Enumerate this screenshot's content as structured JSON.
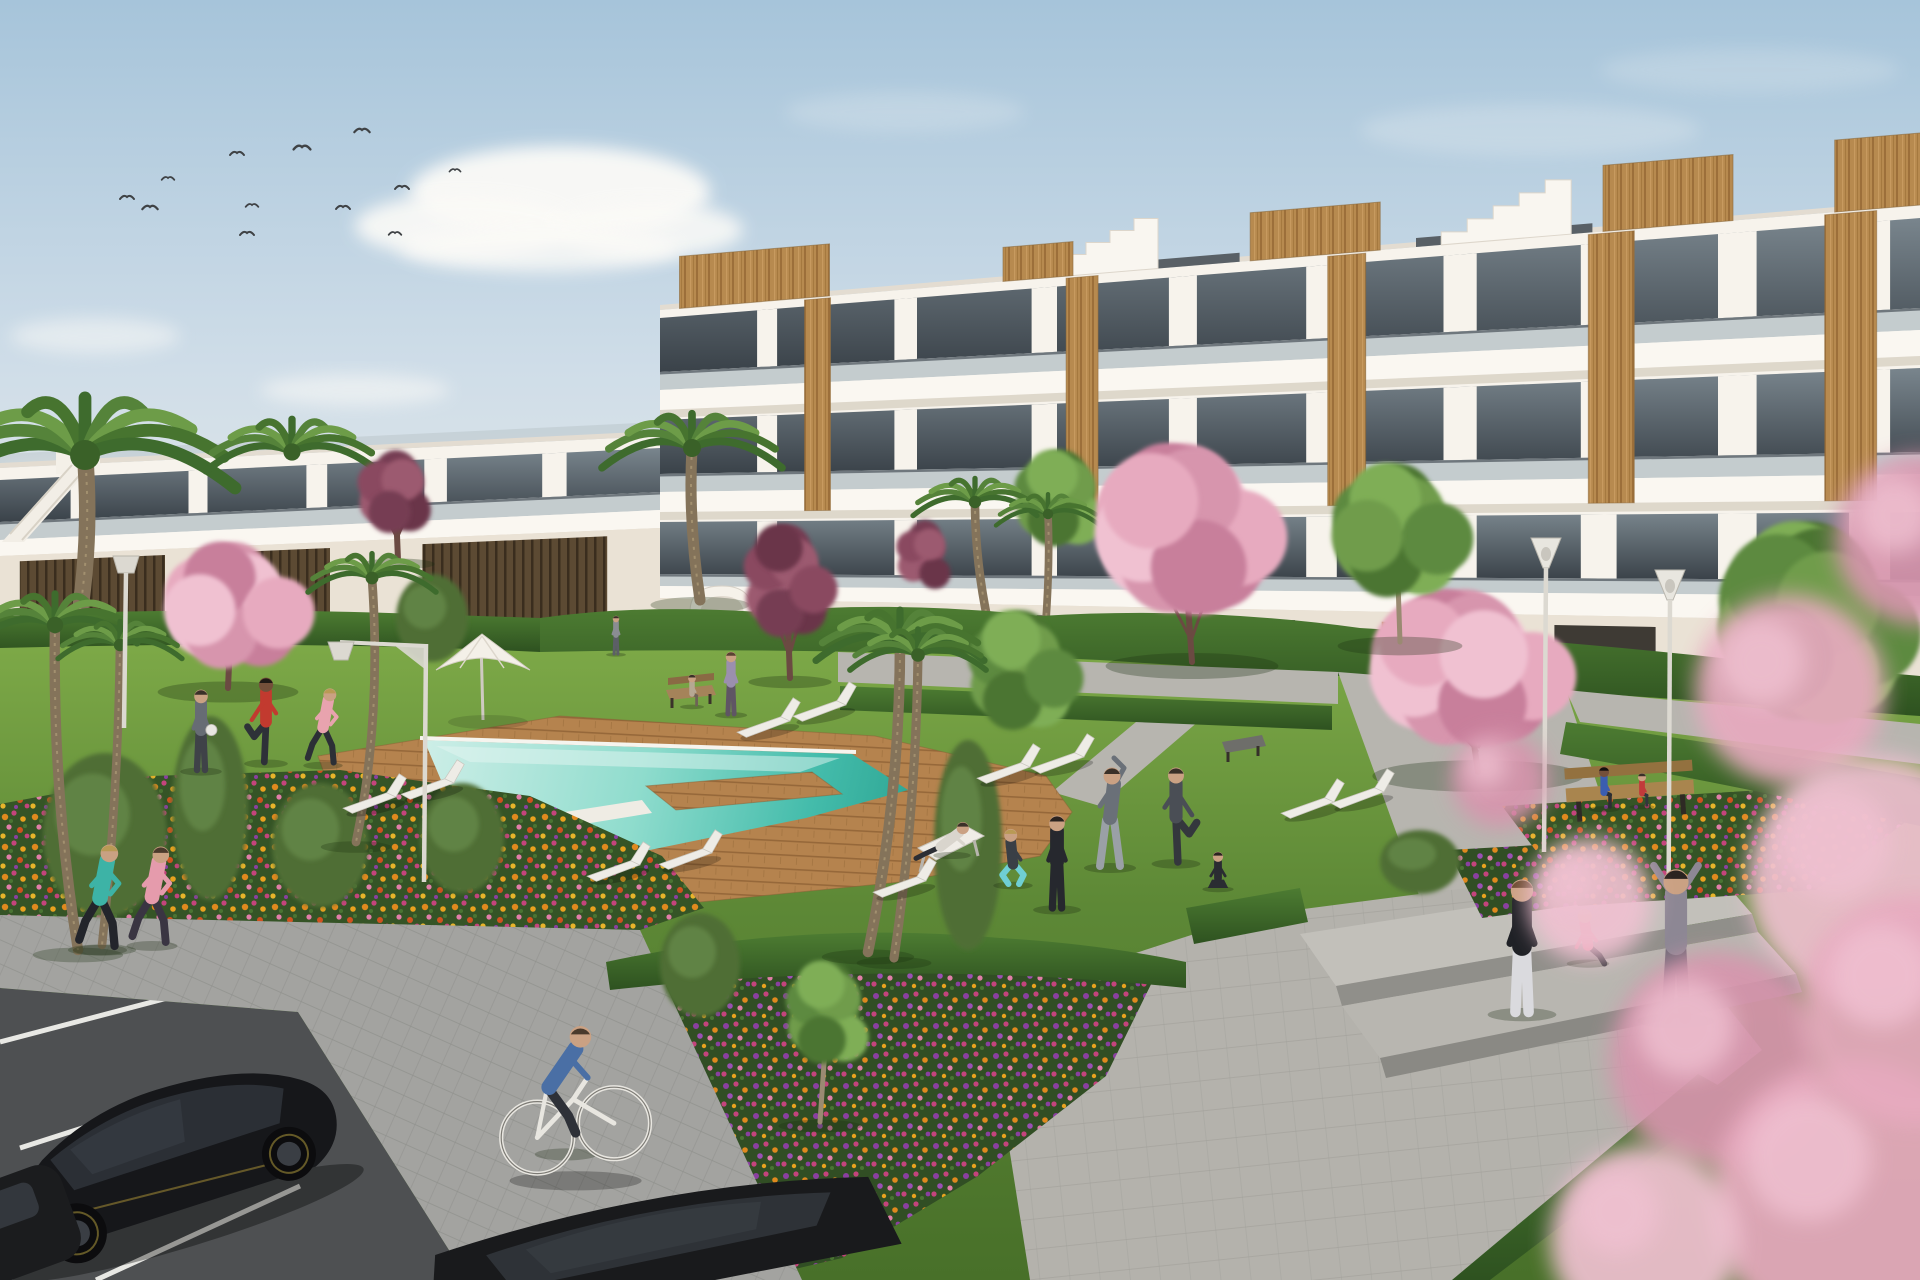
{
  "scene_description": "3D architectural rendering of a modern white apartment complex with wood accents, communal lawn, turquoise swimming pool with wooden deck, flower beds, cherry-blossom and palm trees, residents exercising, jogging and cycling; parked black cars on a road in the lower left, concrete plaza with steps on the right, birds in a pale blue sky.",
  "colors": {
    "sky_top": "#a6c4da",
    "sky_mid": "#cfdde8",
    "sky_horizon": "#e9ece9",
    "cloud": "#fbfaf7",
    "wall": "#f7f3ec",
    "wall_shade": "#eae2d5",
    "slab": "#faf7f1",
    "slab_shadow": "#d9d2c6",
    "glass_rail": "#b6c0c5",
    "window_top": "#79858d",
    "window_bottom": "#3a4249",
    "wood": "#b78a4f",
    "wood_grain": "#9c6f3a",
    "slat_dark": "#5c4a33",
    "lawn_light": "#82ae4a",
    "lawn_mid": "#5d8836",
    "lawn_dark": "#487029",
    "hedge_light": "#4d7c32",
    "hedge_dark": "#2e5220",
    "pool_far": "#cdeee7",
    "pool_mid": "#8fdccd",
    "pool_near": "#44bcab",
    "pool_deep": "#2fa795",
    "deck": "#b5834e",
    "deck_line": "#8f6234",
    "path": "#b7b5af",
    "plaza": "#b4b2ac",
    "paver": "#a3a3a0",
    "road": "#4e5052",
    "road_line": "#e8e8e4",
    "flower_orange": "#e0891e",
    "flower_gold": "#e8a21f",
    "flower_magenta": "#c4447c",
    "flower_pink": "#e07ea8",
    "flower_purple": "#8a3fa0",
    "blossom_pink": [
      "#e7aabf",
      "#f0c1d1",
      "#d795ad",
      "#c87f9b"
    ],
    "blossom_maroon": [
      "#8a4a60",
      "#9c5a70",
      "#763c52",
      "#6b3448"
    ],
    "green_tree": [
      "#5d8a3f",
      "#6f9c4c",
      "#4c7433",
      "#7fae57"
    ],
    "palm_fronds": [
      "#3e6b2d",
      "#55833a",
      "#6d9c48",
      "#47742f"
    ],
    "trunk": "#84735a",
    "blossom_trunk": "#6b4a42",
    "lamp": "#dcd9d1",
    "bench_wood": "#a9854e",
    "lounger": "#eeece6",
    "car_body": "#16171a",
    "car_glass": "#2b2f35",
    "car_accent": "#9a8433"
  },
  "sky": {
    "clouds": [
      {
        "x": 560,
        "y": 192,
        "rx": 150,
        "ry": 46,
        "o": 0.95
      },
      {
        "x": 465,
        "y": 226,
        "rx": 110,
        "ry": 32,
        "o": 0.9
      },
      {
        "x": 648,
        "y": 230,
        "rx": 95,
        "ry": 28,
        "o": 0.85
      },
      {
        "x": 540,
        "y": 248,
        "rx": 140,
        "ry": 24,
        "o": 0.8
      },
      {
        "x": 95,
        "y": 336,
        "rx": 85,
        "ry": 18,
        "o": 0.5
      },
      {
        "x": 355,
        "y": 390,
        "rx": 95,
        "ry": 16,
        "o": 0.55
      },
      {
        "x": 250,
        "y": 470,
        "rx": 80,
        "ry": 13,
        "o": 0.45
      },
      {
        "x": 58,
        "y": 468,
        "rx": 60,
        "ry": 11,
        "o": 0.4
      },
      {
        "x": 1115,
        "y": 452,
        "rx": 150,
        "ry": 18,
        "o": 0.5
      },
      {
        "x": 1015,
        "y": 428,
        "rx": 90,
        "ry": 14,
        "o": 0.4
      },
      {
        "x": 1530,
        "y": 130,
        "rx": 170,
        "ry": 26,
        "o": 0.22
      },
      {
        "x": 1750,
        "y": 70,
        "rx": 150,
        "ry": 22,
        "o": 0.18
      },
      {
        "x": 905,
        "y": 112,
        "rx": 120,
        "ry": 20,
        "o": 0.2
      }
    ],
    "birds": [
      [
        127,
        197,
        1
      ],
      [
        150,
        207,
        1.1
      ],
      [
        168,
        178,
        0.9
      ],
      [
        237,
        153,
        1
      ],
      [
        247,
        233,
        1
      ],
      [
        252,
        205,
        0.9
      ],
      [
        302,
        147,
        1.2
      ],
      [
        343,
        207,
        1
      ],
      [
        362,
        130,
        1.1
      ],
      [
        395,
        233,
        0.9
      ],
      [
        402,
        187,
        1
      ],
      [
        455,
        170,
        0.8
      ]
    ]
  },
  "buildings": {
    "right": {
      "x0": 660,
      "x1": 1920,
      "roof": [
        310,
        205
      ],
      "base": [
        688,
        716
      ],
      "pierW0": 18,
      "pierWGrow": 24,
      "piers": [
        0.085,
        0.195,
        0.305,
        0.415,
        0.525,
        0.635,
        0.745,
        0.855,
        0.96
      ],
      "rows": [
        {
          "g": [
            318,
            218,
            372,
            308
          ],
          "rail": [
            390,
            330
          ],
          "slab": [
            410,
            356
          ]
        },
        {
          "g": [
            420,
            368,
            474,
            452
          ],
          "rail": [
            492,
            474
          ],
          "slab": [
            512,
            500
          ]
        },
        {
          "g": [
            522,
            512,
            574,
            580
          ],
          "rail": [
            586,
            596
          ],
          "slab": [
            598,
            622
          ]
        }
      ],
      "wood": [
        {
          "f": 0.125,
          "w": 26
        },
        {
          "f": 0.335,
          "w": 32
        },
        {
          "f": 0.545,
          "w": 38
        },
        {
          "f": 0.755,
          "w": 46
        },
        {
          "f": 0.945,
          "w": 52
        }
      ],
      "roofBoxes": [
        {
          "f": 0.075,
          "w": 150,
          "h": 52
        },
        {
          "f": 0.3,
          "w": 70,
          "h": 34
        },
        {
          "f": 0.52,
          "w": 130,
          "h": 48
        },
        {
          "f": 0.8,
          "w": 130,
          "h": 66
        },
        {
          "f": 0.97,
          "w": 95,
          "h": 72
        }
      ],
      "trim": [
        [
          0.32,
          0.46
        ],
        [
          0.6,
          0.74
        ]
      ],
      "gables": [
        {
          "f": 0.3,
          "w": 120,
          "steps": 5,
          "sh": 12
        },
        {
          "f": 0.62,
          "w": 130,
          "steps": 5,
          "sh": 13
        }
      ],
      "openings": [
        0.05,
        0.19,
        0.33,
        0.47,
        0.61,
        0.75,
        0.89
      ]
    },
    "left": {
      "x0": 0,
      "x1": 660,
      "roof": [
        468,
        436
      ],
      "base": [
        644,
        622
      ],
      "pierW0": 16,
      "pierWGrow": 10,
      "piers": [
        0.12,
        0.3,
        0.48,
        0.66,
        0.84
      ],
      "rows": [
        {
          "g": [
            480,
            448,
            522,
            492
          ],
          "rail": [
            540,
            510
          ],
          "slab": [
            556,
            528
          ]
        }
      ],
      "slats": [
        [
          0.03,
          0.25
        ],
        [
          0.33,
          0.5
        ],
        [
          0.64,
          0.92
        ]
      ],
      "roofRail": true
    }
  },
  "trees": {
    "palms": [
      {
        "cx": 85,
        "cy": 455,
        "r": 150,
        "trunk": [
          60,
          705
        ],
        "ctrl": [
          95,
          580
        ],
        "layer": "back"
      },
      {
        "cx": 292,
        "cy": 452,
        "r": 86,
        "layer": "back"
      },
      {
        "cx": 692,
        "cy": 448,
        "r": 90,
        "trunk": [
          700,
          600
        ],
        "ctrl": [
          688,
          520
        ],
        "layer": "back"
      },
      {
        "cx": 975,
        "cy": 502,
        "r": 62,
        "trunk": [
          988,
          622
        ],
        "ctrl": [
          975,
          560
        ],
        "layer": "back"
      },
      {
        "cx": 1048,
        "cy": 514,
        "r": 52,
        "trunk": [
          1046,
          620
        ],
        "ctrl": [
          1050,
          560
        ],
        "layer": "back"
      },
      {
        "cx": 372,
        "cy": 578,
        "r": 64,
        "trunk": [
          356,
          842
        ],
        "ctrl": [
          382,
          720
        ],
        "layer": "mid"
      },
      {
        "cx": 900,
        "cy": 642,
        "r": 84,
        "trunk": [
          868,
          952
        ],
        "ctrl": [
          900,
          800
        ],
        "layer": "fore"
      },
      {
        "cx": 918,
        "cy": 655,
        "r": 68,
        "trunk": [
          894,
          958
        ],
        "ctrl": [
          916,
          810
        ],
        "layer": "fore"
      },
      {
        "cx": 55,
        "cy": 625,
        "r": 82,
        "trunk": [
          78,
          950
        ],
        "ctrl": [
          52,
          790
        ],
        "layer": "fore"
      },
      {
        "cx": 120,
        "cy": 645,
        "r": 62,
        "trunk": [
          102,
          945
        ],
        "ctrl": [
          118,
          800
        ],
        "layer": "fore"
      }
    ],
    "blossoms": [
      {
        "cx": 232,
        "cy": 598,
        "rx": 88,
        "ry": 78,
        "pal": "pink",
        "trunk": [
          228,
          688
        ],
        "layer": "mid"
      },
      {
        "cx": 395,
        "cy": 486,
        "rx": 46,
        "ry": 58,
        "pal": "maroon",
        "trunk": [
          398,
          560
        ],
        "layer": "mid"
      },
      {
        "cx": 786,
        "cy": 572,
        "rx": 52,
        "ry": 92,
        "pal": "maroon",
        "trunk": [
          790,
          678
        ],
        "layer": "mid"
      },
      {
        "cx": 924,
        "cy": 550,
        "rx": 34,
        "ry": 56,
        "pal": "maroon",
        "layer": "mid"
      },
      {
        "cx": 1182,
        "cy": 518,
        "rx": 108,
        "ry": 104,
        "pal": "pink",
        "trunk": [
          1192,
          662
        ],
        "layer": "mid"
      },
      {
        "cx": 1462,
        "cy": 658,
        "rx": 132,
        "ry": 96,
        "pal": "pink",
        "trunk": [
          1478,
          772
        ],
        "layer": "mid"
      }
    ],
    "fore_blossom_blobs": [
      [
        1790,
        690,
        95
      ],
      [
        1872,
        880,
        125
      ],
      [
        1718,
        1060,
        108
      ],
      [
        1850,
        1200,
        140
      ],
      [
        1590,
        900,
        62
      ],
      [
        1500,
        780,
        48
      ],
      [
        1915,
        1010,
        115
      ],
      [
        1645,
        1240,
        95
      ],
      [
        1920,
        540,
        85
      ]
    ],
    "greens": [
      {
        "cx": 1060,
        "cy": 492,
        "rx": 56,
        "ry": 64,
        "layer": "back"
      },
      {
        "cx": 1396,
        "cy": 522,
        "rx": 78,
        "ry": 88,
        "trunk": [
          1400,
          642
        ],
        "layer": "mid"
      },
      {
        "cx": 1810,
        "cy": 608,
        "rx": 112,
        "ry": 135,
        "layer": "mid"
      },
      {
        "cx": 1020,
        "cy": 662,
        "rx": 64,
        "ry": 86,
        "layer": "mid"
      },
      {
        "cx": 828,
        "cy": 1005,
        "rx": 52,
        "ry": 78,
        "trunk": [
          820,
          1122
        ],
        "layer": "fore"
      }
    ],
    "shrubs": [
      [
        105,
        835,
        62,
        82
      ],
      [
        320,
        845,
        48,
        62
      ],
      [
        462,
        838,
        42,
        55
      ],
      [
        210,
        808,
        38,
        92
      ],
      [
        700,
        965,
        40,
        52
      ],
      [
        968,
        845,
        34,
        105
      ],
      [
        1420,
        862,
        40,
        32
      ],
      [
        432,
        618,
        36,
        44
      ]
    ]
  },
  "furniture": {
    "loungers": [
      [
        372,
        800
      ],
      [
        430,
        786
      ],
      [
        766,
        724
      ],
      [
        822,
        708
      ],
      [
        1006,
        770
      ],
      [
        1060,
        760
      ],
      [
        616,
        868
      ],
      [
        688,
        856
      ],
      [
        902,
        884
      ],
      [
        1310,
        805
      ],
      [
        1360,
        795
      ]
    ],
    "lamps": [
      {
        "t": "trap",
        "x": 126,
        "top": 556,
        "base": 728
      },
      {
        "t": "arm",
        "x": 426,
        "top": 644,
        "base": 882
      },
      {
        "t": "cone",
        "x": 1546,
        "top": 568,
        "base": 852
      },
      {
        "t": "cone",
        "x": 1670,
        "top": 600,
        "base": 1016
      }
    ]
  },
  "people": [
    {
      "pose": "jog",
      "x": 100,
      "y": 948,
      "h": 104,
      "top": "#3db3a6",
      "pants": "#23252b",
      "skin": "#c9a183",
      "hair": "#b99a55"
    },
    {
      "pose": "jog",
      "x": 152,
      "y": 944,
      "h": 98,
      "top": "#e59bac",
      "pants": "#3a3542",
      "skin": "#c9a183",
      "hair": "#4a3a2c"
    },
    {
      "pose": "stand",
      "x": 201,
      "y": 770,
      "h": 80,
      "top": "#676c74",
      "pants": "#3f4248",
      "skin": "#caa183",
      "hair": "#3a3028",
      "ball": true
    },
    {
      "pose": "kick",
      "x": 266,
      "y": 762,
      "h": 84,
      "top": "#c23a2f",
      "pants": "#2e3138",
      "skin": "#74503a",
      "hair": "#201a16"
    },
    {
      "pose": "jog",
      "x": 323,
      "y": 764,
      "h": 76,
      "top": "#e8a3ae",
      "pants": "#2c2f36",
      "skin": "#caa183",
      "hair": "#b99a55"
    },
    {
      "pose": "stand",
      "x": 731,
      "y": 714,
      "h": 62,
      "top": "#9b8fae",
      "pants": "#5f5564",
      "skin": "#caa183",
      "hair": "#5a4332"
    },
    {
      "pose": "stand",
      "x": 616,
      "y": 654,
      "h": 38,
      "top": "#8a8d92",
      "pants": "#5c5f66",
      "skin": "#caa183",
      "hair": "#3a3028"
    },
    {
      "pose": "lounge",
      "x": 952,
      "y": 854,
      "h": 72,
      "top": "#d9d5cd",
      "pants": "#2c2e34",
      "skin": "#caa183",
      "hair": "#3a3028"
    },
    {
      "pose": "squat",
      "x": 1013,
      "y": 884,
      "h": 76,
      "top": "#3a3f46",
      "pants": "#6fcfd4",
      "skin": "#caa183",
      "hair": "#b99a55"
    },
    {
      "pose": "stand",
      "x": 1057,
      "y": 908,
      "h": 92,
      "top": "#26282e",
      "pants": "#26282e",
      "skin": "#caa183",
      "hair": "#2a2320"
    },
    {
      "pose": "sidestretch",
      "x": 1110,
      "y": 866,
      "h": 100,
      "top": "#6a7078",
      "pants": "#9aa0a6",
      "skin": "#caa183",
      "hair": "#3a3028"
    },
    {
      "pose": "kick",
      "x": 1176,
      "y": 862,
      "h": 94,
      "top": "#4a4e55",
      "pants": "#34373d",
      "skin": "#caa183",
      "hair": "#3a3028",
      "flip": true
    },
    {
      "pose": "sitcross",
      "x": 1218,
      "y": 888,
      "h": 60,
      "top": "#2a2c32",
      "pants": "#2a2c32",
      "skin": "#caa183",
      "hair": "#2a2320"
    },
    {
      "pose": "stand",
      "x": 1522,
      "y": 1012,
      "h": 132,
      "top": "#1f2126",
      "pants": "#dadade",
      "skin": "#caa183",
      "hair": "#6b4a2f"
    },
    {
      "pose": "sitsteps",
      "x": 1588,
      "y": 962,
      "h": 82,
      "top": "#e57f90",
      "pants": "#2c2e33",
      "skin": "#d8b59a",
      "hair": "#d8c8a8"
    },
    {
      "pose": "armsup",
      "x": 1676,
      "y": 1018,
      "h": 148,
      "top": "#8d8794",
      "pants": "#716b78",
      "skin": "#caa183",
      "hair": "#2a2320"
    },
    {
      "pose": "benchsit",
      "x": 1604,
      "y": 808,
      "h": 60,
      "top": "#3b5db0",
      "pants": "#2c2e33",
      "skin": "#74503a",
      "hair": "#14100e"
    },
    {
      "pose": "benchsit",
      "x": 1642,
      "y": 806,
      "h": 48,
      "top": "#c23a3a",
      "pants": "#33363c",
      "skin": "#caa183",
      "hair": "#3a3028"
    },
    {
      "pose": "benchsit",
      "x": 692,
      "y": 706,
      "h": 46,
      "top": "#b6a893",
      "pants": "#6e6257",
      "skin": "#caa183",
      "hair": "#3a3028"
    },
    {
      "pose": "cyclist",
      "x": 566,
      "y": 1152,
      "h": 120,
      "top": "#4a6fa5",
      "pants": "#2e3138",
      "skin": "#caa183",
      "hair": "#4a3a2c"
    }
  ]
}
